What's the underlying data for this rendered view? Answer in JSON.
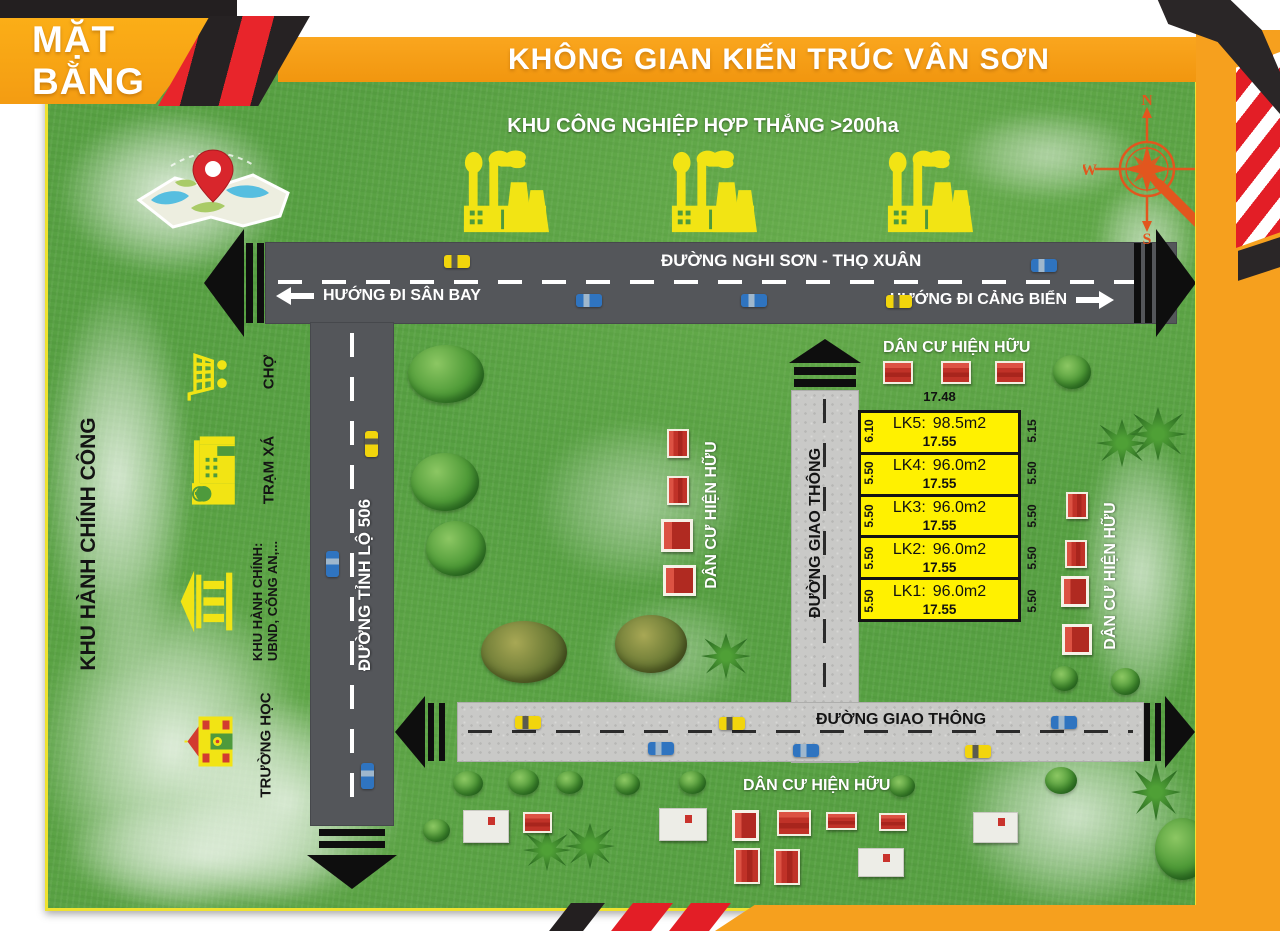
{
  "header": {
    "site_plan_label": "MẶT BẰNG",
    "title": "KHÔNG GIAN KIẾN TRÚC VÂN SƠN"
  },
  "map": {
    "industrial_zone_label": "KHU CÔNG NGHIỆP HỢP THẮNG >200ha",
    "main_road": {
      "name": "ĐƯỜNG NGHI SƠN - THỌ XUÂN",
      "airport_direction": "HƯỚNG ĐI SÂN BAY",
      "seaport_direction": "HƯỚNG ĐI CẢNG BIỂN"
    },
    "provincial_road_name": "ĐƯỜNG TỈNH LỘ 506",
    "vertical_service_road_name": "ĐƯỜNG GIAO THÔNG",
    "bottom_service_road_name": "ĐƯỜNG GIAO THÔNG",
    "residential": {
      "top": "DÂN CƯ HIỆN HỮU",
      "middle": "DÂN CƯ HIỆN HỮU",
      "right": "DÂN CƯ HIỆN HỮU",
      "bottom": "DÂN CƯ HIỆN HỮU"
    },
    "admin_zone": {
      "title": "KHU HÀNH CHÍNH CÔNG",
      "items": [
        {
          "icon": "market-cart-icon",
          "label": "CHỢ"
        },
        {
          "icon": "clinic-icon",
          "label": "TRẠM XÁ"
        },
        {
          "icon": "government-building-icon",
          "label_line1": "KHU HÀNH CHÍNH:",
          "label_line2": "UBND, CÔNG AN,..."
        },
        {
          "icon": "school-icon",
          "label": "TRƯỜNG HỌC"
        }
      ]
    },
    "compass": {
      "n": "N",
      "e": "E",
      "s": "S",
      "w": "W"
    },
    "icons": [
      "map-pin-icon",
      "compass-rose-icon",
      "factory-icon",
      "house-icon",
      "car-icon",
      "tree-icon",
      "palm-tree-icon"
    ]
  },
  "plots": {
    "top_width": "17.48",
    "rows": [
      {
        "label": "LK5:",
        "area": "98.5m2",
        "width": "17.55",
        "left_dim": "6.10",
        "right_dim": "5.15"
      },
      {
        "label": "LK4:",
        "area": "96.0m2",
        "width": "17.55",
        "left_dim": "5.50",
        "right_dim": "5.50"
      },
      {
        "label": "LK3:",
        "area": "96.0m2",
        "width": "17.55",
        "left_dim": "5.50",
        "right_dim": "5.50"
      },
      {
        "label": "LK2:",
        "area": "96.0m2",
        "width": "17.55",
        "left_dim": "5.50",
        "right_dim": "5.50"
      },
      {
        "label": "LK1:",
        "area": "96.0m2",
        "width": "17.55",
        "left_dim": "5.50",
        "right_dim": "5.50"
      }
    ]
  },
  "colors": {
    "banner_orange": "#F9A11B",
    "grass_green": "#58A143",
    "road_dark": "#54565A",
    "road_concrete": "#C9C9C7",
    "plot_yellow": "#FFF100",
    "house_red": "#C9332C",
    "icon_yellow": "#F2E414",
    "compass_orange": "#E2561E",
    "ribbon_red": "#E8252B",
    "ribbon_black": "#231F20"
  }
}
